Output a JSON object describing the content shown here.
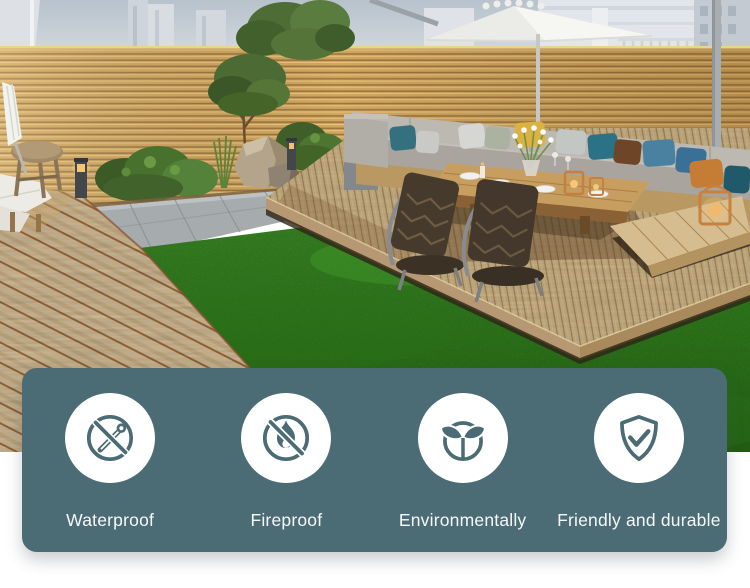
{
  "features_banner": {
    "background_color": "#4b6b75",
    "text_color": "#f5f8f8",
    "icon_bg": "#ffffff",
    "icon_color": "#4b6b75",
    "items": [
      {
        "label": "Waterproof",
        "icon": "no-water-drop-icon"
      },
      {
        "label": "Fireproof",
        "icon": "no-fire-icon"
      },
      {
        "label": "Environmentally",
        "icon": "eco-plant-icon"
      },
      {
        "label": "Friendly and durable",
        "icon": "shield-check-icon"
      }
    ]
  },
  "scene": {
    "colors": {
      "sky": "#c2cbd4",
      "buildings": "#dde2e7",
      "fence_wood": "#d1a65f",
      "lawn": "#3f9e28",
      "paver": "#a6acae",
      "deck_left_wood": "#dcc59e",
      "deck_right_wood": "#cfb689",
      "umbrella": "#f4f4f1",
      "foliage": "#4c6b33",
      "cushion_gray": "#b5b1ab"
    }
  }
}
